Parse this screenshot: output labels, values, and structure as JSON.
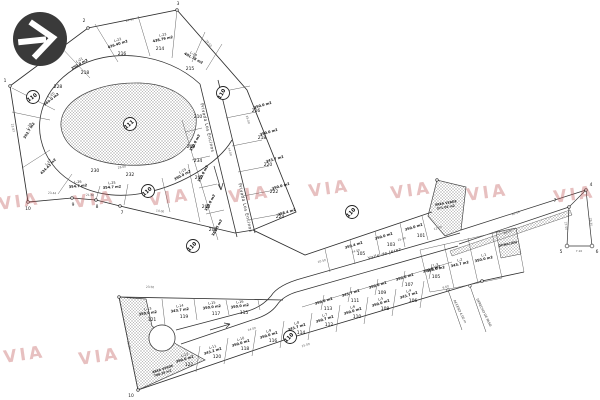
{
  "logo": {
    "icon": "arrow-right-icon",
    "bg_color": "#3a3a3a",
    "fg_color": "#ffffff"
  },
  "watermark": {
    "text": "VIA",
    "color": "#c25b5b",
    "instances": [
      {
        "x": 20,
        "y": 207,
        "r": -8
      },
      {
        "x": 95,
        "y": 205,
        "r": -8
      },
      {
        "x": 170,
        "y": 203,
        "r": -8
      },
      {
        "x": 250,
        "y": 200,
        "r": -8
      },
      {
        "x": 330,
        "y": 194,
        "r": -8
      },
      {
        "x": 412,
        "y": 196,
        "r": -8
      },
      {
        "x": 488,
        "y": 198,
        "r": -8
      },
      {
        "x": 575,
        "y": 200,
        "r": -8
      },
      {
        "x": 25,
        "y": 360,
        "r": -8
      },
      {
        "x": 100,
        "y": 362,
        "r": -8
      }
    ]
  },
  "map": {
    "street_names": [
      {
        "text": "Privada Los Encinos",
        "x": 206,
        "y": 128,
        "r": 77
      },
      {
        "text": "Privada Los Encinos",
        "x": 244,
        "y": 208,
        "r": 77
      },
      {
        "text": "Valle de Jerez",
        "x": 385,
        "y": 255,
        "r": -16
      }
    ],
    "block_markers": [
      {
        "text": "110",
        "x": 33,
        "y": 97,
        "r": -35
      },
      {
        "text": "110",
        "x": 223,
        "y": 93,
        "r": -60
      },
      {
        "text": "110",
        "x": 148,
        "y": 191,
        "r": -40
      },
      {
        "text": "110",
        "x": 352,
        "y": 212,
        "r": -45
      },
      {
        "text": "110",
        "x": 193,
        "y": 246,
        "r": -45
      },
      {
        "text": "110",
        "x": 290,
        "y": 337,
        "r": -45
      }
    ],
    "island_marker": {
      "text": "111",
      "x": 130,
      "y": 124,
      "r": -40
    },
    "lots": [
      {
        "id": "L-23",
        "area": "438.79 m2",
        "x": 163,
        "y": 36,
        "r": -12
      },
      {
        "id": "L-24",
        "area": "401.78 m2",
        "x": 193,
        "y": 55,
        "r": 28
      },
      {
        "id": "L-22",
        "area": "426.40 m2",
        "x": 118,
        "y": 41,
        "r": -18
      },
      {
        "id": "L-21",
        "area": "350.0 m2",
        "x": 80,
        "y": 61,
        "r": -30
      },
      {
        "id": "L-20",
        "area": "360.0 m2",
        "x": 52,
        "y": 96,
        "r": -38
      },
      {
        "id": "L-28",
        "area": "352.7 m2",
        "x": 30,
        "y": 127,
        "r": -58
      },
      {
        "id": "L-27",
        "area": "434.43 m2",
        "x": 49,
        "y": 163,
        "r": -45
      },
      {
        "id": "L-26",
        "area": "354.7 m2",
        "x": 78,
        "y": 183,
        "r": -6
      },
      {
        "id": "L-25",
        "area": "354.7 m2",
        "x": 112,
        "y": 184,
        "r": -4
      },
      {
        "id": "L-19",
        "area": "350.0 m2",
        "x": 183,
        "y": 172,
        "r": -28
      },
      {
        "id": "",
        "area": "350.0 m2",
        "x": 196,
        "y": 139,
        "r": -62
      },
      {
        "id": "",
        "area": "350.0 m2",
        "x": 204,
        "y": 170,
        "r": -62
      },
      {
        "id": "",
        "area": "350.0 m2",
        "x": 211,
        "y": 199,
        "r": -62
      },
      {
        "id": "",
        "area": "389.5 m2",
        "x": 218,
        "y": 224,
        "r": -62
      },
      {
        "id": "",
        "area": "350.0 m2",
        "x": 263,
        "y": 102,
        "r": -16
      },
      {
        "id": "",
        "area": "350.0 m2",
        "x": 269,
        "y": 129,
        "r": -16
      },
      {
        "id": "",
        "area": "343.7 m2",
        "x": 275,
        "y": 156,
        "r": -16
      },
      {
        "id": "",
        "area": "350.0 m2",
        "x": 281,
        "y": 183,
        "r": -16
      },
      {
        "id": "",
        "area": "358.4 m2",
        "x": 287,
        "y": 209,
        "r": -16
      },
      {
        "id": "",
        "area": "350.0 m2",
        "x": 414,
        "y": 224,
        "r": -17
      },
      {
        "id": "",
        "area": "350.0 m2",
        "x": 384,
        "y": 233,
        "r": -17
      },
      {
        "id": "",
        "area": "359.4 m2",
        "x": 354,
        "y": 242,
        "r": -17
      },
      {
        "id": "",
        "area": "350.0 m2",
        "x": 432,
        "y": 266,
        "r": -17
      },
      {
        "id": "",
        "area": "350.0 m2",
        "x": 405,
        "y": 274,
        "r": -17
      },
      {
        "id": "",
        "area": "350.0 m2",
        "x": 378,
        "y": 282,
        "r": -17
      },
      {
        "id": "",
        "area": "343.7 m2",
        "x": 351,
        "y": 290,
        "r": -17
      },
      {
        "id": "",
        "area": "350.0 m2",
        "x": 324,
        "y": 298,
        "r": -17
      },
      {
        "id": "L-16",
        "area": "350.0 m2",
        "x": 240,
        "y": 303,
        "r": -8
      },
      {
        "id": "L-15",
        "area": "350.0 m2",
        "x": 212,
        "y": 304,
        "r": -8
      },
      {
        "id": "L-14",
        "area": "343.7 m2",
        "x": 180,
        "y": 307,
        "r": -8
      },
      {
        "id": "L-13",
        "area": "350.0 m2",
        "x": 148,
        "y": 310,
        "r": -8
      },
      {
        "id": "L-12",
        "area": "350.0 m2",
        "x": 185,
        "y": 356,
        "r": -17
      },
      {
        "id": "L-11",
        "area": "343.2 m2",
        "x": 213,
        "y": 348,
        "r": -17
      },
      {
        "id": "L-10",
        "area": "350.0 m2",
        "x": 241,
        "y": 340,
        "r": -17
      },
      {
        "id": "L-9",
        "area": "350.0 m2",
        "x": 269,
        "y": 332,
        "r": -17
      },
      {
        "id": "L-8",
        "area": "343.7 m2",
        "x": 297,
        "y": 324,
        "r": -17
      },
      {
        "id": "L-7",
        "area": "350.7 m2",
        "x": 325,
        "y": 316,
        "r": -17
      },
      {
        "id": "L-6",
        "area": "350.0 m2",
        "x": 353,
        "y": 308,
        "r": -17
      },
      {
        "id": "L-5",
        "area": "350.0 m2",
        "x": 381,
        "y": 300,
        "r": -17
      },
      {
        "id": "L-4",
        "area": "343.7 m2",
        "x": 409,
        "y": 292,
        "r": -17
      },
      {
        "id": "L-3",
        "area": "350.0 m2",
        "x": 436,
        "y": 266,
        "r": -13
      },
      {
        "id": "L-2",
        "area": "343.7 m2",
        "x": 460,
        "y": 261,
        "r": -13
      },
      {
        "id": "L-1",
        "area": "350.0 m2",
        "x": 484,
        "y": 256,
        "r": -13
      }
    ],
    "addresses": [
      {
        "text": "214",
        "x": 160,
        "y": 50
      },
      {
        "text": "215",
        "x": 190,
        "y": 70
      },
      {
        "text": "216",
        "x": 122,
        "y": 55
      },
      {
        "text": "218",
        "x": 85,
        "y": 74
      },
      {
        "text": "228",
        "x": 58,
        "y": 88
      },
      {
        "text": "230",
        "x": 95,
        "y": 172
      },
      {
        "text": "232",
        "x": 130,
        "y": 176
      },
      {
        "text": "234",
        "x": 198,
        "y": 162
      },
      {
        "text": "210",
        "x": 198,
        "y": 118
      },
      {
        "text": "209",
        "x": 191,
        "y": 148
      },
      {
        "text": "207",
        "x": 199,
        "y": 179
      },
      {
        "text": "205",
        "x": 206,
        "y": 208
      },
      {
        "text": "203",
        "x": 213,
        "y": 231
      },
      {
        "text": "216",
        "x": 256,
        "y": 112
      },
      {
        "text": "218",
        "x": 262,
        "y": 139
      },
      {
        "text": "220",
        "x": 268,
        "y": 166
      },
      {
        "text": "222",
        "x": 274,
        "y": 193
      },
      {
        "text": "224",
        "x": 280,
        "y": 218
      },
      {
        "text": "101",
        "x": 421,
        "y": 237
      },
      {
        "text": "103",
        "x": 391,
        "y": 246
      },
      {
        "text": "105",
        "x": 361,
        "y": 255
      },
      {
        "text": "105",
        "x": 436,
        "y": 278
      },
      {
        "text": "107",
        "x": 409,
        "y": 286
      },
      {
        "text": "109",
        "x": 382,
        "y": 294
      },
      {
        "text": "111",
        "x": 355,
        "y": 302
      },
      {
        "text": "113",
        "x": 328,
        "y": 310
      },
      {
        "text": "115",
        "x": 244,
        "y": 314
      },
      {
        "text": "117",
        "x": 216,
        "y": 315
      },
      {
        "text": "119",
        "x": 184,
        "y": 318
      },
      {
        "text": "121",
        "x": 152,
        "y": 321
      },
      {
        "text": "122",
        "x": 189,
        "y": 366
      },
      {
        "text": "120",
        "x": 217,
        "y": 358
      },
      {
        "text": "118",
        "x": 245,
        "y": 350
      },
      {
        "text": "116",
        "x": 273,
        "y": 342
      },
      {
        "text": "114",
        "x": 301,
        "y": 334
      },
      {
        "text": "112",
        "x": 329,
        "y": 326
      },
      {
        "text": "110",
        "x": 357,
        "y": 318
      },
      {
        "text": "108",
        "x": 385,
        "y": 310
      },
      {
        "text": "106",
        "x": 413,
        "y": 302
      }
    ],
    "green_areas": [
      {
        "lines": [
          "ÁREA VERDE",
          "371.02 m2"
        ],
        "x": 446,
        "y": 204,
        "r": -10
      },
      {
        "lines": [
          "ÁREA VERDE",
          "708.35 m2"
        ],
        "x": 163,
        "y": 370,
        "r": -18
      },
      {
        "lines": [
          "DONACIÓN"
        ],
        "x": 508,
        "y": 245,
        "r": -12
      }
    ],
    "vertices": [
      {
        "text": "1",
        "x": 5,
        "y": 82
      },
      {
        "text": "2",
        "x": 84,
        "y": 22
      },
      {
        "text": "3",
        "x": 178,
        "y": 5
      },
      {
        "text": "7",
        "x": 122,
        "y": 214
      },
      {
        "text": "8",
        "x": 97,
        "y": 208
      },
      {
        "text": "9",
        "x": 73,
        "y": 206
      },
      {
        "text": "10",
        "x": 28,
        "y": 210
      },
      {
        "text": "10",
        "x": 131,
        "y": 397
      },
      {
        "text": "4",
        "x": 591,
        "y": 186
      },
      {
        "text": "5",
        "x": 561,
        "y": 253
      },
      {
        "text": "6",
        "x": 597,
        "y": 253
      },
      {
        "text": "7",
        "x": 555,
        "y": 202
      }
    ],
    "dimensions": [
      {
        "text": "24.30",
        "x": 130,
        "y": 21,
        "r": -13
      },
      {
        "text": "17.35",
        "x": 50,
        "y": 54,
        "r": -37
      },
      {
        "text": "29.55",
        "x": 208,
        "y": 44,
        "r": 49
      },
      {
        "text": "22.87",
        "x": 12,
        "y": 128,
        "r": 80
      },
      {
        "text": "23.44",
        "x": 52,
        "y": 194,
        "r": 4
      },
      {
        "text": "21.60",
        "x": 90,
        "y": 196,
        "r": 4
      },
      {
        "text": "14.00",
        "x": 160,
        "y": 212,
        "r": 8
      },
      {
        "text": "25.00",
        "x": 247,
        "y": 120,
        "r": 73
      },
      {
        "text": "14.00",
        "x": 229,
        "y": 152,
        "r": 73
      },
      {
        "text": "28.00",
        "x": 122,
        "y": 168,
        "r": -10
      },
      {
        "text": "10.50",
        "x": 322,
        "y": 262,
        "r": -16
      },
      {
        "text": "14.00",
        "x": 356,
        "y": 252,
        "r": -16
      },
      {
        "text": "25.00",
        "x": 402,
        "y": 240,
        "r": -16
      },
      {
        "text": "12.00",
        "x": 438,
        "y": 229,
        "r": -16
      },
      {
        "text": "85.10",
        "x": 516,
        "y": 214,
        "r": -19
      },
      {
        "text": "64.20",
        "x": 508,
        "y": 233,
        "r": -19
      },
      {
        "text": "29.30",
        "x": 590,
        "y": 222,
        "r": 85
      },
      {
        "text": "27.50",
        "x": 565,
        "y": 226,
        "r": 85
      },
      {
        "text": "7.10",
        "x": 579,
        "y": 252,
        "r": 0
      },
      {
        "text": "23.50",
        "x": 150,
        "y": 288,
        "r": 2
      },
      {
        "text": "14.00",
        "x": 252,
        "y": 330,
        "r": -16
      },
      {
        "text": "25.00",
        "x": 306,
        "y": 346,
        "r": -17
      },
      {
        "text": "9.60",
        "x": 446,
        "y": 288,
        "r": -17
      },
      {
        "text": "31.20",
        "x": 128,
        "y": 345,
        "r": 78
      }
    ],
    "notes": [
      {
        "text": "ACCESO 4.00 m",
        "x": 459,
        "y": 312,
        "r": 64
      },
      {
        "text": "DERECHO DE PASO",
        "x": 483,
        "y": 313,
        "r": 64
      }
    ]
  }
}
